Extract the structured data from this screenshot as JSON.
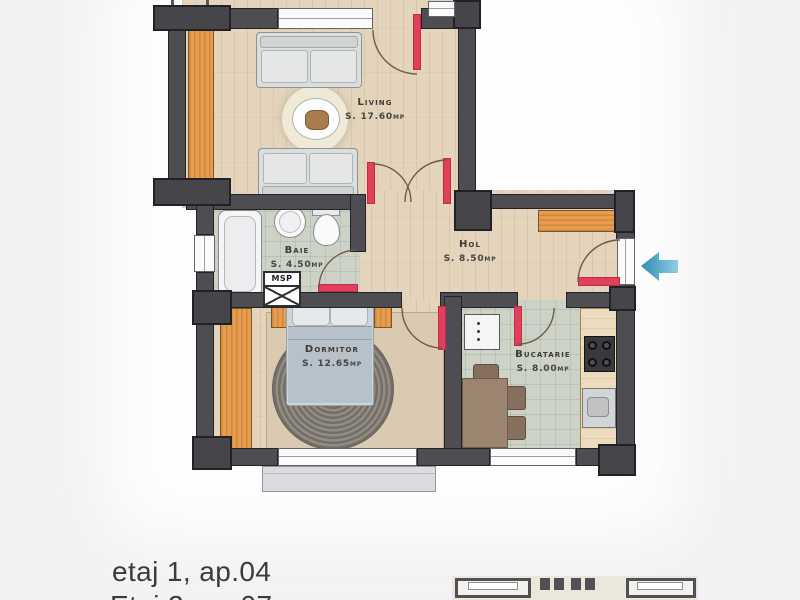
{
  "floorplan": {
    "rooms": [
      {
        "name": "Living",
        "area": "S. 17.60mp"
      },
      {
        "name": "Baie",
        "area": "S. 4.50mp"
      },
      {
        "name": "Hol",
        "area": "S. 8.50mp"
      },
      {
        "name": "Dormitor",
        "area": "S. 12.65mp"
      },
      {
        "name": "Bucatarie",
        "area": "S. 8.00mp"
      }
    ],
    "washing_machine_label": "MSP",
    "entrance": {
      "icon": "arrow-left-icon",
      "color": "#3F9EC0"
    },
    "colors": {
      "wall": "#4D4D52",
      "door_leaf": "#E23F5C",
      "wood_furniture": "#E79C4E",
      "wood_floor": "#E3D4BB",
      "tile_floor": "#CDD2C6"
    }
  },
  "captions": {
    "line1": "etaj 1, ap.04",
    "line2": "Etaj 2, ap.07"
  }
}
